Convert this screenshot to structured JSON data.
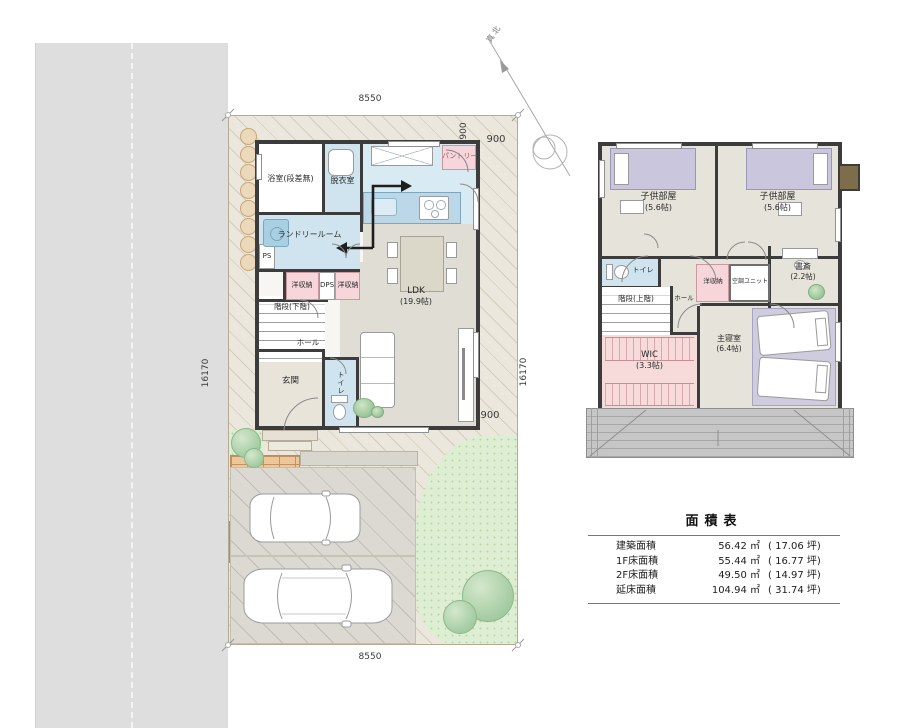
{
  "dims": {
    "top": "8550",
    "bottom": "8550",
    "left": "16170",
    "right": "16170",
    "offset_top_v": "900",
    "offset_top_h": "900",
    "offset_bottom": "900"
  },
  "compass": {
    "label": "真北"
  },
  "f1": {
    "bath": "浴室(段差無)",
    "dressing": "脱衣室",
    "pantry": "パントリー",
    "laundry": "ランドリールーム",
    "ps": "PS",
    "closet_left": "洋収納",
    "dps": "DPS",
    "closet_right": "洋収納",
    "stairs": "階段(下階)",
    "ldk": "LDK",
    "ldk_size": "(19.9帖)",
    "hall": "ホール",
    "entrance": "玄関",
    "toilet": "トイレ"
  },
  "f2": {
    "child_left": "子供部屋",
    "child_left_size": "(5.6帖)",
    "child_right": "子供部屋",
    "child_right_size": "(5.6帖)",
    "toilet": "トイレ",
    "stairs": "階段(上階)",
    "hall": "ホール",
    "closet": "洋収納",
    "ac_unit": "空調ユニット",
    "study": "書斎",
    "study_size": "(2.2帖)",
    "wic": "WIC",
    "wic_size": "(3.3帖)",
    "master": "主寝室",
    "master_size": "(6.4帖)"
  },
  "area_table": {
    "title": "面積表",
    "rows": [
      {
        "label": "建築面積",
        "m2": "56.42 ㎡",
        "tsubo": "( 17.06 坪)"
      },
      {
        "label": "1F床面積",
        "m2": "55.44 ㎡",
        "tsubo": "( 16.77 坪)"
      },
      {
        "label": "2F床面積",
        "m2": "49.50 ㎡",
        "tsubo": "( 14.97 坪)"
      },
      {
        "label": "延床面積",
        "m2": "104.94 ㎡",
        "tsubo": "( 31.74 坪)"
      }
    ]
  },
  "colors": {
    "wall": "#3c3c3c",
    "water_blue": "#cfe4ee",
    "closet_pink": "#f6d6da",
    "bed_purple": "#c9c6de",
    "site_beige": "#ece7dc",
    "lawn_green": "#ddeed2",
    "road_gray": "#dedede"
  }
}
